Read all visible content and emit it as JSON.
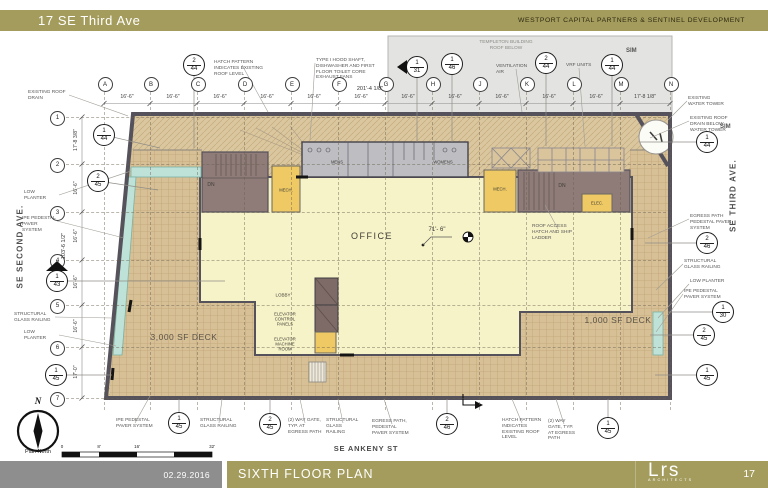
{
  "header": {
    "project": "17 SE Third Ave",
    "client": "WESTPORT CAPITAL PARTNERS & SENTINEL DEVELOPMENT"
  },
  "footer": {
    "date": "02.29.2016",
    "sheet_title": "SIXTH FLOOR PLAN",
    "logo": "Lrs",
    "logo_sub": "ARCHITECTS",
    "page": "17"
  },
  "streets": {
    "west": "SE SECOND AVE.",
    "east": "SE THIRD AVE.",
    "south": "SE ANKENY ST"
  },
  "compass": {
    "letter": "N",
    "caption": "Plan North"
  },
  "scale_bar": {
    "labels": [
      "0",
      "8'",
      "16'",
      "32'"
    ]
  },
  "colors": {
    "olive_bar": "#a49c5c",
    "gray_bar": "#8e8e8e",
    "deck_tan": "#d7c096",
    "roof_hatch_tan": "#dbc79f",
    "office_yellow": "#f7f3c8",
    "planter_teal": "#bfe2d8",
    "wall_gray": "#55525b",
    "stair_brown": "#8f7c79",
    "mech_gold": "#eec964",
    "restroom_gray": "#bdbdc2",
    "elevator_brown": "#7e6a67"
  },
  "plan": {
    "total_width_dim": "201'-4 1/8\"",
    "total_height_dim": "103'-6 1/2\"",
    "office_dim": "71'- 6\"",
    "grid_columns": [
      {
        "label": "A",
        "x": 104
      },
      {
        "label": "B",
        "x": 150
      },
      {
        "label": "C",
        "x": 197
      },
      {
        "label": "D",
        "x": 244
      },
      {
        "label": "E",
        "x": 291
      },
      {
        "label": "F",
        "x": 338
      },
      {
        "label": "G",
        "x": 385
      },
      {
        "label": "H",
        "x": 432
      },
      {
        "label": "J",
        "x": 479
      },
      {
        "label": "K",
        "x": 526
      },
      {
        "label": "L",
        "x": 573
      },
      {
        "label": "M",
        "x": 620
      },
      {
        "label": "N",
        "x": 670
      }
    ],
    "column_dims": [
      {
        "text": "16'-6\"",
        "x": 127
      },
      {
        "text": "16'-6\"",
        "x": 173
      },
      {
        "text": "16'-6\"",
        "x": 220
      },
      {
        "text": "16'-6\"",
        "x": 267
      },
      {
        "text": "16'-6\"",
        "x": 314
      },
      {
        "text": "16'-6\"",
        "x": 361
      },
      {
        "text": "16'-6\"",
        "x": 408
      },
      {
        "text": "16'-6\"",
        "x": 455
      },
      {
        "text": "16'-6\"",
        "x": 502
      },
      {
        "text": "16'-6\"",
        "x": 549
      },
      {
        "text": "16'-6\"",
        "x": 596
      },
      {
        "text": "17'-8 1/8\"",
        "x": 645
      }
    ],
    "grid_rows": [
      {
        "label": "1",
        "y": 117
      },
      {
        "label": "2",
        "y": 164
      },
      {
        "label": "3",
        "y": 212
      },
      {
        "label": "4",
        "y": 260
      },
      {
        "label": "5",
        "y": 305
      },
      {
        "label": "6",
        "y": 347
      },
      {
        "label": "7",
        "y": 398
      }
    ],
    "row_dims": [
      {
        "text": "17'-8 3/8\"",
        "y": 140
      },
      {
        "text": "16'-6\"",
        "y": 188
      },
      {
        "text": "16'-6\"",
        "y": 236
      },
      {
        "text": "16'-6\"",
        "y": 282
      },
      {
        "text": "16'-6\"",
        "y": 326
      },
      {
        "text": "17'-0\"",
        "y": 372
      }
    ],
    "room_labels": [
      {
        "text": "OFFICE",
        "x": 372,
        "y": 236,
        "fs": 9,
        "ls": 1.5
      },
      {
        "text": "LOBBY",
        "x": 283,
        "y": 295,
        "fs": 4.5
      },
      {
        "text": "ELEVATOR CONTROL PANELS",
        "x": 285,
        "y": 319,
        "fs": 4.2,
        "w": 28
      },
      {
        "text": "ELEVATOR MACHINE ROOM",
        "x": 285,
        "y": 344,
        "fs": 4.2,
        "w": 28
      },
      {
        "text": "MECH.",
        "x": 286,
        "y": 190,
        "fs": 4.2
      },
      {
        "text": "MECH.",
        "x": 500,
        "y": 189,
        "fs": 4.2
      },
      {
        "text": "ELEC.",
        "x": 597,
        "y": 203,
        "fs": 4.2
      },
      {
        "text": "DN",
        "x": 211,
        "y": 185,
        "fs": 5
      },
      {
        "text": "DN",
        "x": 562,
        "y": 186,
        "fs": 5
      },
      {
        "text": "MENS",
        "x": 337,
        "y": 162,
        "fs": 4.2
      },
      {
        "text": "WOMENS",
        "x": 443,
        "y": 162,
        "fs": 4.2
      }
    ],
    "deck_labels": [
      {
        "text": "3,000 SF DECK",
        "x": 184,
        "y": 337,
        "fs": 8.5
      },
      {
        "text": "1,000 SF DECK",
        "x": 618,
        "y": 320,
        "fs": 8.5
      }
    ],
    "callouts": [
      {
        "text": "EXISTING ROOF DRAIN",
        "x": 28,
        "y": 90,
        "w": 40,
        "lx": 128,
        "ly": 116
      },
      {
        "text": "HATCH PATTERN INDICATES EXISTING ROOF LEVEL",
        "x": 214,
        "y": 60,
        "w": 56,
        "lx": 268,
        "ly": 112
      },
      {
        "text": "TYPE I HOOD SHAFT, DISHWASHER AND FIRST FLOOR TOILET CORE EXHAUST FANS",
        "x": 316,
        "y": 58,
        "w": 66,
        "lx": 310,
        "ly": 140
      },
      {
        "text": "TEMPLETON BUILDING ROOF BELOW",
        "x": 478,
        "y": 40,
        "w": 56,
        "align": "center",
        "color": "#8a8a86"
      },
      {
        "text": "VENTILATION AIR",
        "x": 496,
        "y": 64,
        "w": 40,
        "lx": 522,
        "ly": 112
      },
      {
        "text": "VRF UNITS",
        "x": 566,
        "y": 63,
        "w": 26,
        "lx": 585,
        "ly": 146
      },
      {
        "text": "EXISTING WATER TOWER",
        "x": 688,
        "y": 96,
        "w": 40,
        "lx": 668,
        "ly": 120
      },
      {
        "text": "EXISTING ROOF DRAIN BELOW WATER TOWER",
        "x": 690,
        "y": 116,
        "w": 48,
        "lx": 650,
        "ly": 138
      },
      {
        "text": "SIM",
        "x": 720,
        "y": 124,
        "w": 20,
        "fs": 6,
        "bold": true
      },
      {
        "text": "SIM",
        "x": 626,
        "y": 48,
        "w": 20,
        "fs": 6,
        "bold": true
      },
      {
        "text": "EGRESS PATH PEDESTAL PAVER SYSTEM",
        "x": 690,
        "y": 214,
        "w": 52,
        "lx": 648,
        "ly": 238
      },
      {
        "text": "STRUCTURAL GLASS RAILING",
        "x": 684,
        "y": 259,
        "w": 48,
        "lx": 656,
        "ly": 290
      },
      {
        "text": "LOW PLANTER",
        "x": 690,
        "y": 279,
        "w": 44,
        "lx": 658,
        "ly": 318
      },
      {
        "text": "IPE PEDESTAL PAVER SYSTEM",
        "x": 684,
        "y": 289,
        "w": 48,
        "lx": 656,
        "ly": 332
      },
      {
        "text": "LOW PLANTER",
        "x": 24,
        "y": 190,
        "w": 34,
        "lx": 131,
        "ly": 171
      },
      {
        "text": "IPE PEDESTAL PAVER SYSTEM",
        "x": 22,
        "y": 216,
        "w": 34,
        "lx": 124,
        "ly": 238
      },
      {
        "text": "STRUCTURAL GLASS RAILING",
        "x": 14,
        "y": 312,
        "w": 40,
        "lx": 112,
        "ly": 318
      },
      {
        "text": "LOW PLANTER",
        "x": 24,
        "y": 330,
        "w": 34,
        "lx": 116,
        "ly": 346
      },
      {
        "text": "IPE PEDESTAL PAVER SYSTEM",
        "x": 116,
        "y": 418,
        "w": 38,
        "lx": 150,
        "ly": 396
      },
      {
        "text": "STRUCTURAL GLASS RAILING",
        "x": 200,
        "y": 418,
        "w": 38,
        "lx": 222,
        "ly": 399
      },
      {
        "text": "(2) WAY GATE, TYP. AT EGRESS PATH",
        "x": 288,
        "y": 418,
        "w": 34,
        "lx": 300,
        "ly": 399
      },
      {
        "text": "STRUCTURAL GLASS RAILING",
        "x": 326,
        "y": 418,
        "w": 34,
        "lx": 338,
        "ly": 399
      },
      {
        "text": "EGRESS PATH, PEDESTAL PAVER SYSTEM",
        "x": 372,
        "y": 419,
        "w": 40,
        "lx": 384,
        "ly": 399
      },
      {
        "text": "HATCH PATTERN INDICATES EXISTING ROOF LEVEL",
        "x": 502,
        "y": 418,
        "w": 40,
        "lx": 512,
        "ly": 399
      },
      {
        "text": "(2) WAY GATE, TYP. AT EGRESS PATH",
        "x": 548,
        "y": 419,
        "w": 32,
        "lx": 556,
        "ly": 399
      },
      {
        "text": "ROOF ACCESS HATCH AND SHIP LADDER",
        "x": 532,
        "y": 224,
        "w": 52,
        "lx": 545,
        "ly": 205
      }
    ],
    "markers": [
      {
        "n": "2",
        "s": "44",
        "x": 194,
        "y": 65,
        "lx": 194,
        "ly": 148
      },
      {
        "n": "1",
        "s": "31",
        "x": 417,
        "y": 67,
        "tri": "left",
        "lx": 417,
        "ly": 142
      },
      {
        "n": "1",
        "s": "46",
        "x": 452,
        "y": 64,
        "lx": 452,
        "ly": 142
      },
      {
        "n": "2",
        "s": "44",
        "x": 546,
        "y": 63,
        "lx": 546,
        "ly": 146
      },
      {
        "n": "1",
        "s": "44",
        "x": 612,
        "y": 65,
        "lx": 612,
        "ly": 146
      },
      {
        "n": "1",
        "s": "44",
        "x": 104,
        "y": 135,
        "lx": 160,
        "ly": 148
      },
      {
        "n": "2",
        "s": "45",
        "x": 98,
        "y": 181,
        "lx": 158,
        "ly": 190
      },
      {
        "n": "1",
        "s": "43",
        "x": 57,
        "y": 281,
        "tri": "up",
        "lx": 225,
        "ly": 281
      },
      {
        "n": "1",
        "s": "45",
        "x": 56,
        "y": 375,
        "lx": 112,
        "ly": 375
      },
      {
        "n": "1",
        "s": "45",
        "x": 179,
        "y": 423,
        "lx": 179,
        "ly": 399
      },
      {
        "n": "2",
        "s": "45",
        "x": 270,
        "y": 424,
        "lx": 270,
        "ly": 399
      },
      {
        "n": "2",
        "s": "46",
        "x": 447,
        "y": 424,
        "lx": 447,
        "ly": 399
      },
      {
        "n": "1",
        "s": "45",
        "x": 608,
        "y": 428,
        "lx": 608,
        "ly": 399
      },
      {
        "n": "1",
        "s": "44",
        "x": 707,
        "y": 142,
        "lx": 640,
        "ly": 142
      },
      {
        "n": "2",
        "s": "46",
        "x": 707,
        "y": 243,
        "lx": 645,
        "ly": 243
      },
      {
        "n": "1",
        "s": "30",
        "x": 723,
        "y": 312,
        "lx": 668,
        "ly": 312
      },
      {
        "n": "2",
        "s": "45",
        "x": 704,
        "y": 335,
        "lx": 650,
        "ly": 335
      },
      {
        "n": "1",
        "s": "45",
        "x": 707,
        "y": 375,
        "lx": 655,
        "ly": 375
      }
    ]
  }
}
